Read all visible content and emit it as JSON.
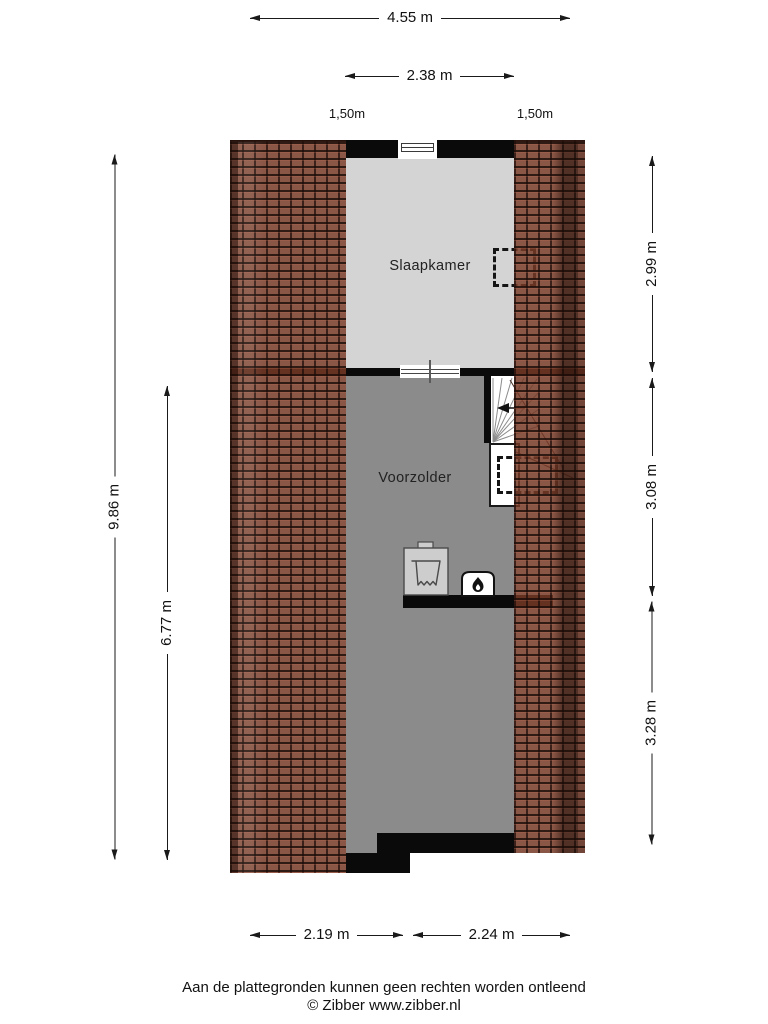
{
  "floorplan": {
    "rooms": [
      {
        "name": "Slaapkamer"
      },
      {
        "name": "Voorzolder"
      }
    ],
    "dimensions": {
      "top": [
        "4.55 m",
        "2.38 m"
      ],
      "height_markers": [
        "1,50m",
        "1,50m"
      ],
      "left": [
        "9.86 m",
        "6.77 m"
      ],
      "right": [
        "2.99 m",
        "3.08 m",
        "3.28 m"
      ],
      "bottom": [
        "2.19 m",
        "2.24 m"
      ]
    },
    "icons": [
      "washing-machine-icon",
      "boiler-flame-icon",
      "stairs-direction-arrow-icon",
      "window-icon",
      "roof-window-dashed-outline"
    ],
    "colors": {
      "roof_tile": "#8a5143",
      "bedroom_floor": "#d4d4d4",
      "attic_floor": "#8b8b8b",
      "wall": "#0a0a0a"
    }
  },
  "footer": {
    "disclaimer": "Aan de plattegronden kunnen geen rechten worden ontleend",
    "copyright": "© Zibber www.zibber.nl"
  }
}
